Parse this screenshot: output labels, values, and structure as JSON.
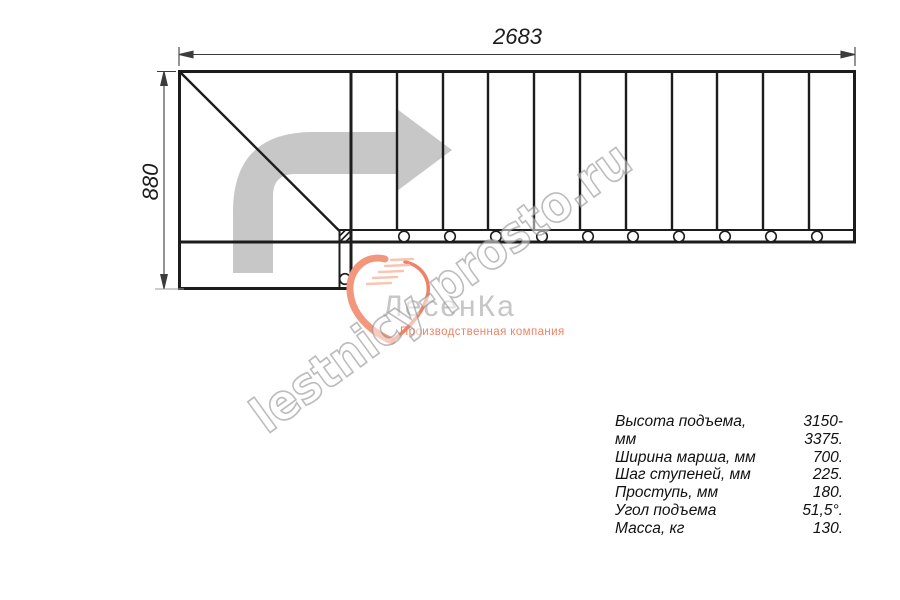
{
  "dimensions": {
    "width_label": "2683",
    "height_label": "880"
  },
  "watermark": {
    "text": "lestnicy-prosto.ru"
  },
  "logo": {
    "brand": "ЛесенКа",
    "tagline": "Производственная компания"
  },
  "specs": {
    "rows": [
      {
        "label": "Высота подъема, мм",
        "value": "3150-3375."
      },
      {
        "label": "Ширина марша, мм",
        "value": "700."
      },
      {
        "label": "Шаг ступеней, мм",
        "value": "225."
      },
      {
        "label": "Проступь, мм",
        "value": "180."
      },
      {
        "label": "Угол подъема",
        "value": "51,5°."
      },
      {
        "label": "Масса, кг",
        "value": "130."
      }
    ]
  },
  "colors": {
    "line_black": "#1c1c1c",
    "arrow_gray": "#c7c7c7",
    "logo_gray": "#c6c6c6",
    "accent_salmon": "#ee8266",
    "salmon_light": "#f8c5b4"
  }
}
